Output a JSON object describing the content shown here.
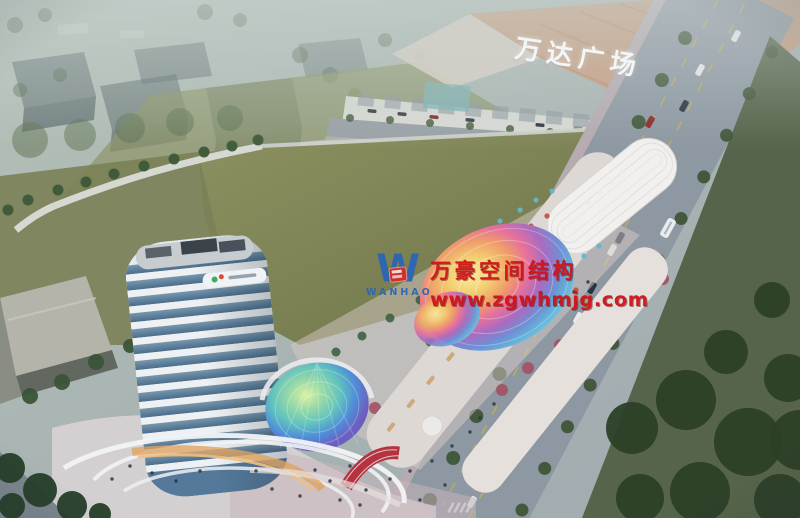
{
  "scene": {
    "mall_sign": "万达广场",
    "watermark": {
      "company": "万豪空间结构",
      "website": "www.zgwhmjg.com",
      "logo_letter": "W",
      "logo_name": "WANHAO"
    },
    "palette": {
      "sky_haze": "#aebdb3",
      "lawn_green": "#7d8455",
      "road_gray": "#8e98a2",
      "tree_green": "#3c5839",
      "tower_white": "#edf1f3",
      "tower_glass": "#5b82a0",
      "mall_roof_tan": "#c79d80",
      "watermark_red": "#d01318",
      "logo_blue": "#2a66b4",
      "canopy_rainbow": [
        "#f7ef9e",
        "#f3cf72",
        "#ef9f68",
        "#e6709c",
        "#a96cc0",
        "#6f8fd4",
        "#62b5da"
      ],
      "dome_rainbow": [
        "#daf0a2",
        "#94d8a8",
        "#60c2be",
        "#4f8ed8",
        "#705cc0"
      ]
    }
  }
}
